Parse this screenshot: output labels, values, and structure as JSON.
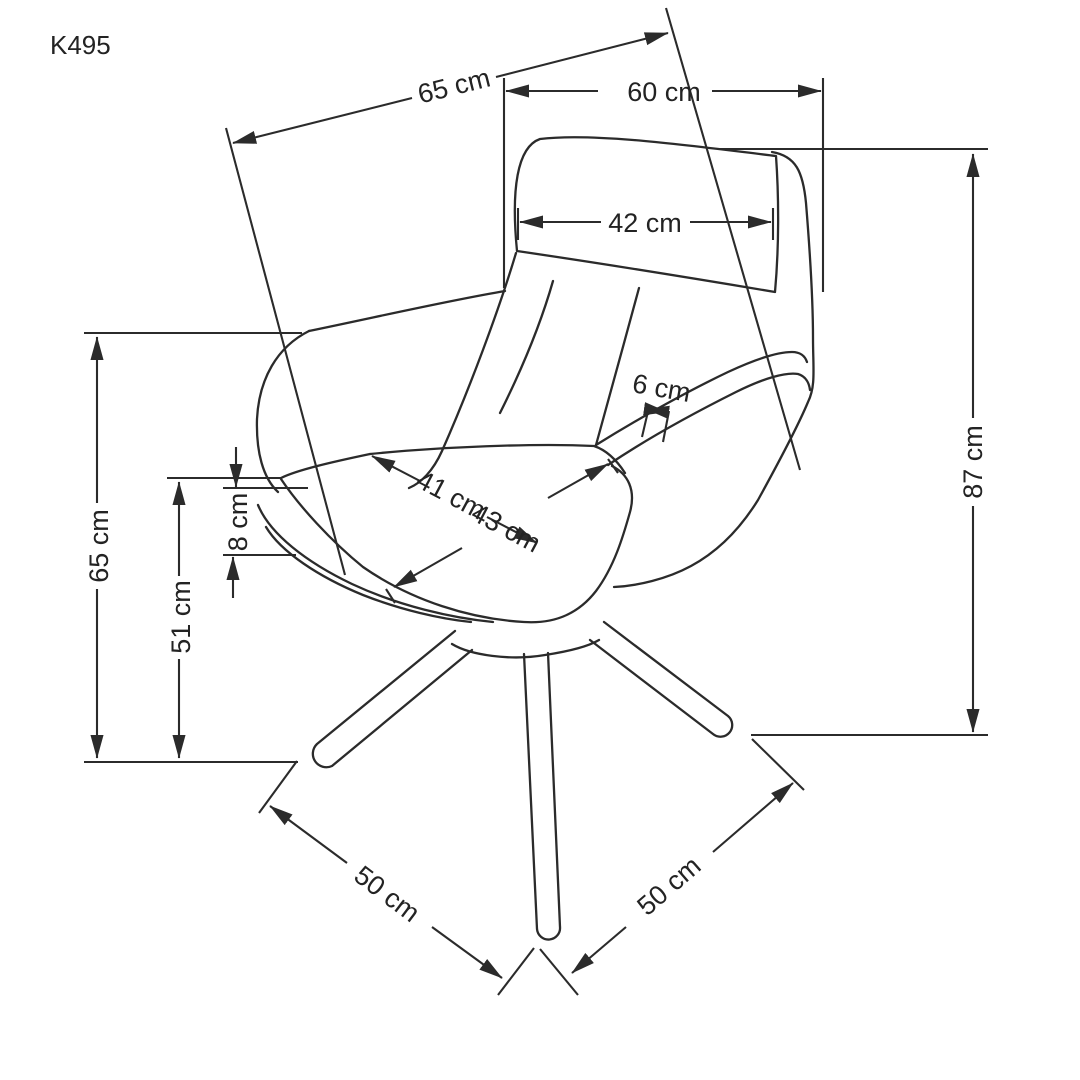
{
  "product_code": "K495",
  "colors": {
    "background": "#ffffff",
    "line": "#2b2b2b",
    "text": "#232323"
  },
  "units": "cm",
  "dimensions": {
    "overall_depth_top": "65 cm",
    "overall_width_top": "60 cm",
    "headrest_width": "42 cm",
    "overall_height": "87 cm",
    "armrest_height_left": "65 cm",
    "seat_height": "51 cm",
    "seat_cushion_thickness": "8 cm",
    "armrest_top_width": "6 cm",
    "seat_depth": "41 cm",
    "seat_width": "43 cm",
    "base_span_front_left": "50 cm",
    "base_span_front_right": "50 cm"
  }
}
